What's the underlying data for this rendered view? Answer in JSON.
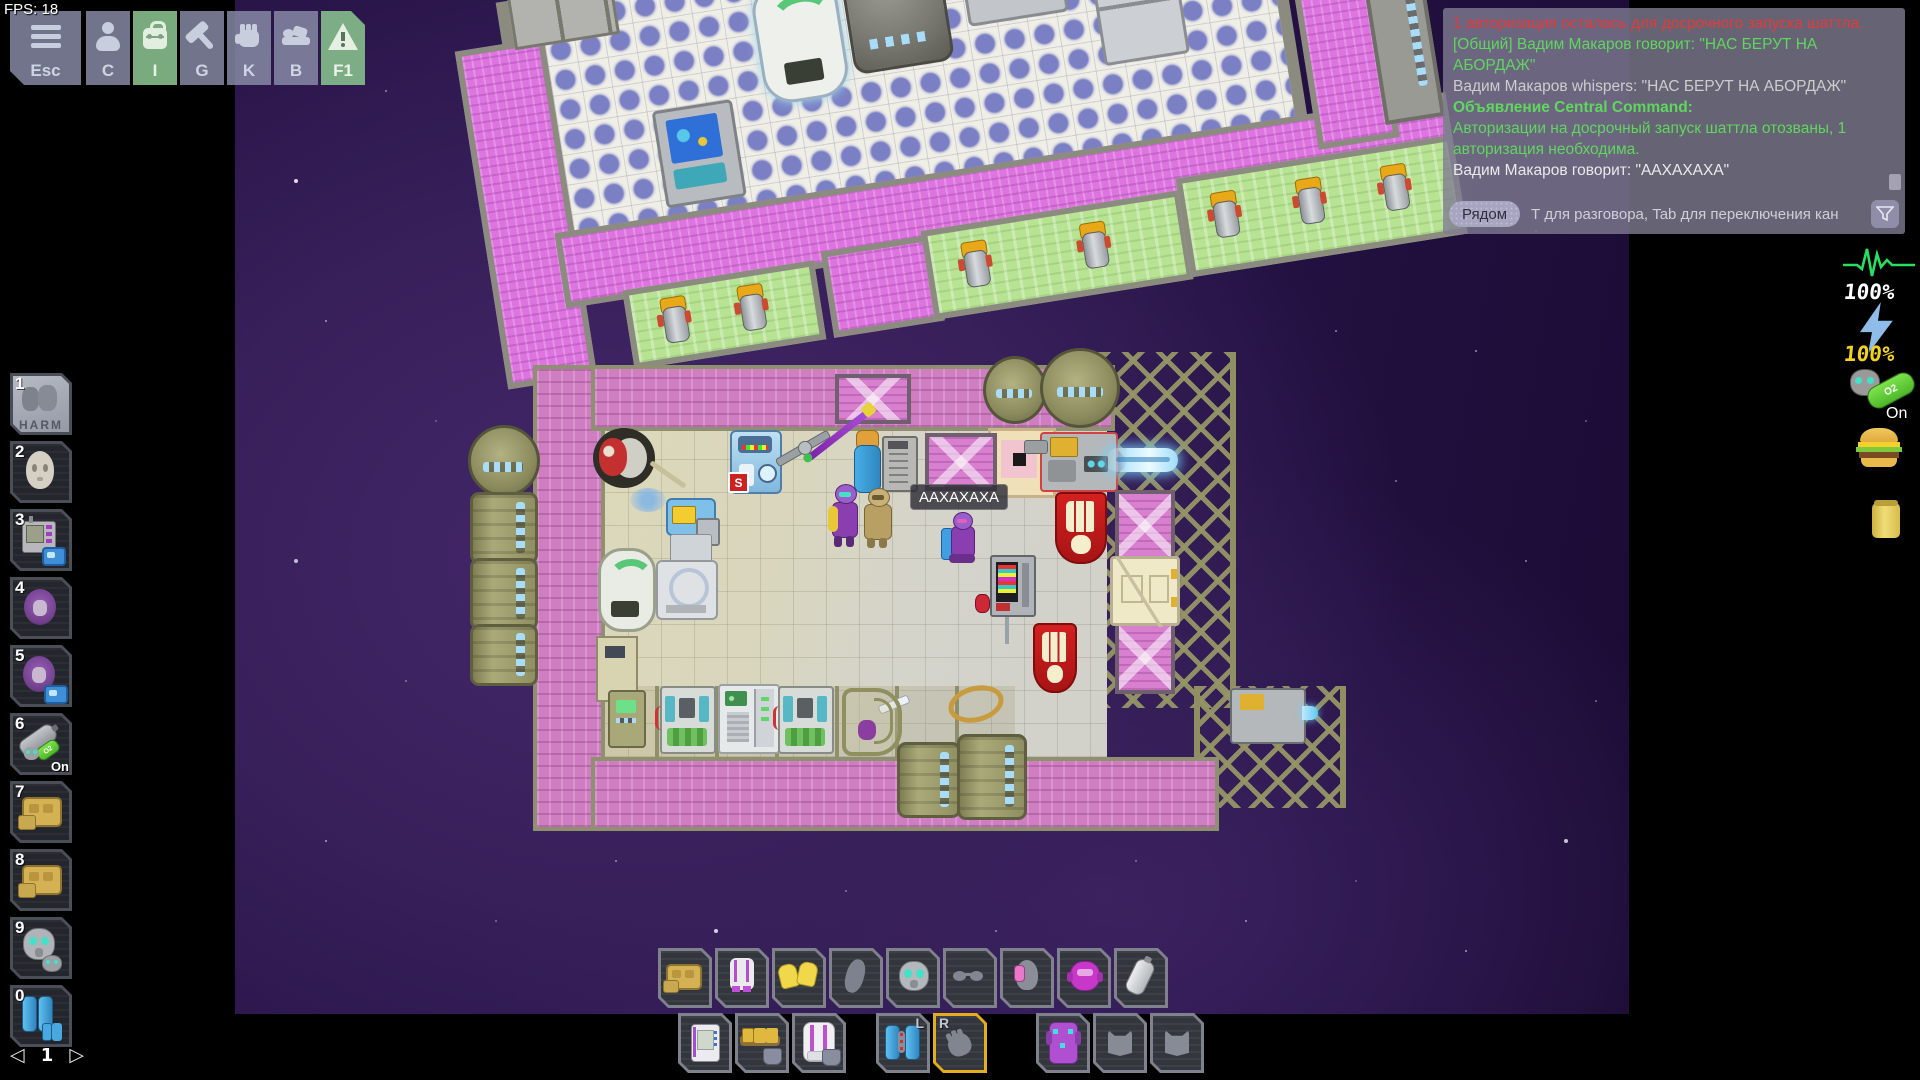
{
  "fps_label": "FPS: 18",
  "menu": {
    "buttons": [
      {
        "key": "Esc",
        "icon": "menu-icon",
        "active": false
      },
      {
        "key": "C",
        "icon": "character-icon",
        "active": false
      },
      {
        "key": "I",
        "icon": "inventory-backpack-icon",
        "active": true
      },
      {
        "key": "G",
        "icon": "crafting-hammer-icon",
        "active": false
      },
      {
        "key": "K",
        "icon": "actions-hand-icon",
        "active": false
      },
      {
        "key": "B",
        "icon": "sandbox-bed-icon",
        "active": false
      },
      {
        "key": "F1",
        "icon": "ahelp-warning-icon",
        "active": true
      }
    ]
  },
  "hotbar": {
    "slots": [
      {
        "num": "1",
        "item": "harm-intent",
        "label": "HARM",
        "selected": true
      },
      {
        "num": "2",
        "item": "ghost-face"
      },
      {
        "num": "3",
        "item": "pda-with-radio"
      },
      {
        "num": "4",
        "item": "void-mask-purple"
      },
      {
        "num": "5",
        "item": "void-mask-purple-radio"
      },
      {
        "num": "6",
        "item": "oxygen-tank-with-mask",
        "badge": "On"
      },
      {
        "num": "7",
        "item": "tan-armor"
      },
      {
        "num": "8",
        "item": "tan-armor"
      },
      {
        "num": "9",
        "item": "gas-mask"
      },
      {
        "num": "0",
        "item": "blue-tanks"
      }
    ],
    "page": {
      "prev": "◁",
      "current": "1",
      "next": "▷"
    }
  },
  "status": {
    "health": "100%",
    "power": "100%",
    "internals": "On",
    "o2_label": "O2",
    "icons": [
      "ecg-health-icon",
      "lightning-power-icon",
      "internals-mask-tank-icon",
      "hunger-burger-icon",
      "thirst-can-icon"
    ]
  },
  "speech_bubble": {
    "text": "ААХАХАХА"
  },
  "world": {
    "s_sign": "S"
  },
  "chat": {
    "messages": [
      {
        "text": "1 авторизация осталась для досрочного запуска шаттла.",
        "type": "alert-red"
      },
      {
        "text": "[Общий] Вадим Макаров говорит: \"НАС БЕРУТ НА АБОРДАЖ\"",
        "type": "say-green"
      },
      {
        "text": "Вадим Макаров whispers: \"НАС БЕРУТ НА АБОРДАЖ\"",
        "type": "whisper-gray"
      },
      {
        "text": "Объявление Central Command:",
        "type": "announce-green-bold"
      },
      {
        "text": "Авторизации на досрочный запуск шаттла отозваны, 1 авторизация необходима.",
        "type": "announce-green"
      },
      {
        "text": "Вадим Макаров говорит: \"ААХАХАХА\"",
        "type": "say-white"
      }
    ],
    "channel_button": "Рядом",
    "input_placeholder": "Т для разговора, Tab для переключения кан",
    "colors": {
      "red": "#e23b3b",
      "green": "#5fd75f",
      "gray": "#cdcdcd",
      "white": "#eaeaea"
    }
  },
  "equipment_row": [
    {
      "item": "armor-tan"
    },
    {
      "item": "jumpsuit-white"
    },
    {
      "item": "gloves-yellow"
    },
    {
      "item": "neck-slot-empty"
    },
    {
      "item": "gas-mask"
    },
    {
      "item": "glasses-slot-empty"
    },
    {
      "item": "ears-headset"
    },
    {
      "item": "head-mask-magenta"
    },
    {
      "item": "oxygen-tank-gray"
    }
  ],
  "hand_row": {
    "l_label": "L",
    "r_label": "R",
    "slots": [
      {
        "item": "pda"
      },
      {
        "item": "utility-belt"
      },
      {
        "item": "backpack-white"
      },
      {
        "item": "jetpack-blue",
        "hand": "L"
      },
      {
        "item": "empty-hand",
        "hand": "R",
        "selected": true
      },
      {
        "item": "exosuit-purple"
      },
      {
        "item": "pocket-empty"
      },
      {
        "item": "pocket-empty"
      }
    ]
  }
}
